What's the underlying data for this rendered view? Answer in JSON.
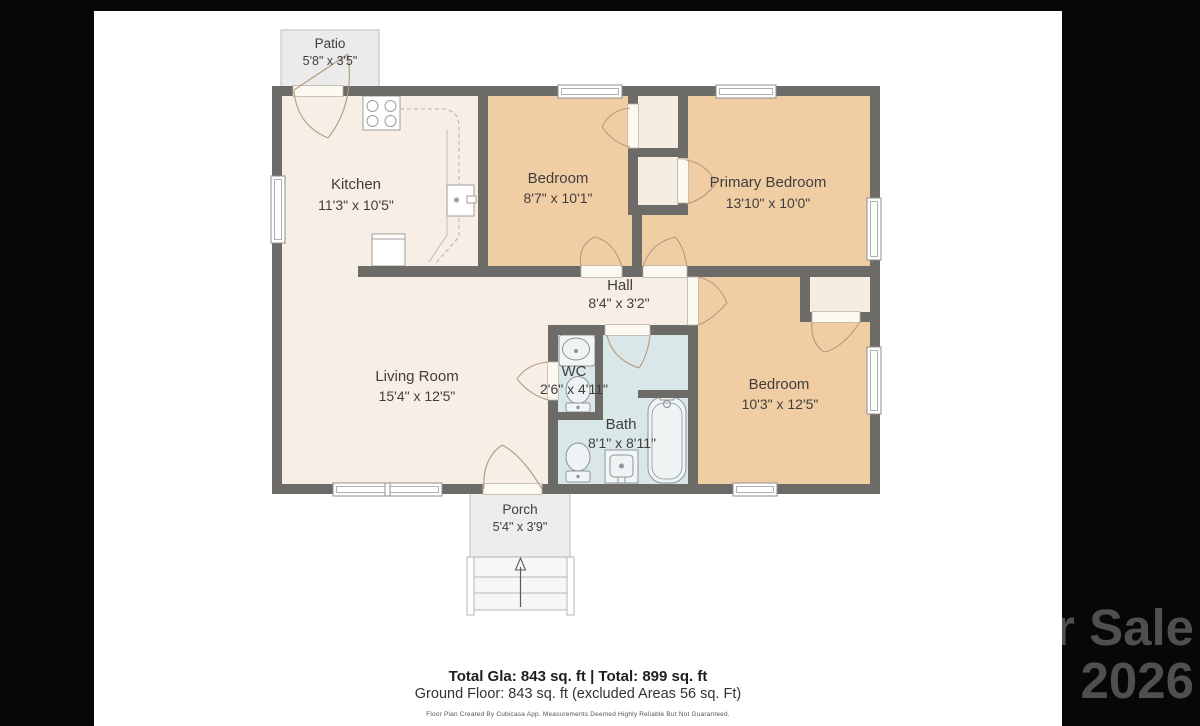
{
  "watermark": {
    "line1": "For Sale",
    "line2": "2026",
    "color": "#4f4f4f"
  },
  "plan": {
    "rooms": {
      "patio": {
        "name": "Patio",
        "dims": "5'8\" x 3'5\""
      },
      "kitchen": {
        "name": "Kitchen",
        "dims": "11'3\" x 10'5\""
      },
      "bedroom1": {
        "name": "Bedroom",
        "dims": "8'7\" x 10'1\""
      },
      "primary": {
        "name": "Primary Bedroom",
        "dims": "13'10\" x 10'0\""
      },
      "hall": {
        "name": "Hall",
        "dims": "8'4\" x 3'2\""
      },
      "living": {
        "name": "Living Room",
        "dims": "15'4\" x 12'5\""
      },
      "wc": {
        "name": "WC",
        "dims": "2'6\" x 4'11\""
      },
      "bath": {
        "name": "Bath",
        "dims": "8'1\" x 8'11\""
      },
      "bedroom3": {
        "name": "Bedroom",
        "dims": "10'3\" x 12'5\""
      },
      "porch": {
        "name": "Porch",
        "dims": "5'4\" x 3'9\""
      }
    },
    "colors": {
      "wall": "#6c6b67",
      "floor_main": "#f7eee6",
      "floor_bedroom": "#f1cda4",
      "floor_bath": "#d9e7e8",
      "outdoor": "#ececec",
      "door_arc": "#b49a7d",
      "label": "#3f3e3c"
    },
    "icons": {
      "stove-icon": "svg-shape",
      "fridge-icon": "svg-shape",
      "kitchen-sink-icon": "svg-shape",
      "wc-sink-icon": "svg-shape",
      "toilet-icon": "svg-shape",
      "bathtub-icon": "svg-shape",
      "vanity-sink-icon": "svg-shape",
      "stairs-up-arrow-icon": "svg-shape",
      "door-swing-icon": "svg-shape",
      "window-icon": "svg-shape"
    }
  },
  "summary": {
    "line1": "Total Gla: 843 sq. ft | Total: 899 sq. ft",
    "line2": "Ground Floor: 843 sq. ft (excluded Areas 56 sq. Ft)",
    "disclaimer": "Floor Plan Created By Cubicasa App. Measurements Deemed Highly Reliable But Not Guaranteed."
  }
}
